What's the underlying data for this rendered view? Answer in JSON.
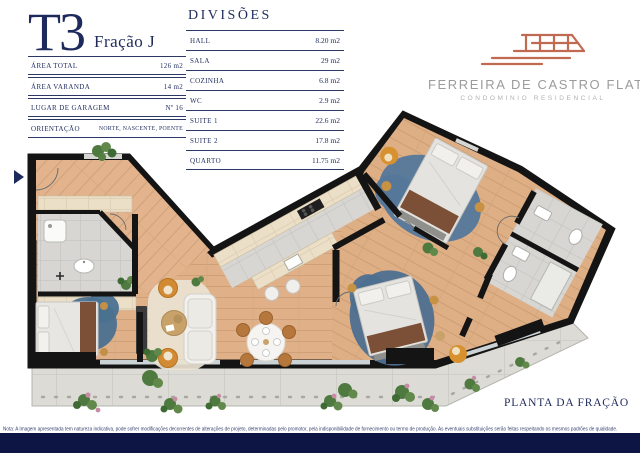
{
  "unit": {
    "type_label": "T3",
    "fraction_label": "Fração J",
    "details": [
      {
        "label": "ÁREA TOTAL",
        "value": "126 m2"
      },
      {
        "label": "ÁREA VARANDA",
        "value": "14 m2"
      },
      {
        "label": "LUGAR DE GARAGEM",
        "value": "Nº 16"
      },
      {
        "label": "ORIENTAÇÃO",
        "value": "NORTE, NASCENTE, POENTE"
      }
    ]
  },
  "divisions": {
    "title": "DIVISÕES",
    "rows": [
      {
        "label": "HALL",
        "value": "8.20 m2"
      },
      {
        "label": "SALA",
        "value": "29 m2"
      },
      {
        "label": "COZINHA",
        "value": "6.8 m2"
      },
      {
        "label": "WC",
        "value": "2.9 m2"
      },
      {
        "label": "SUITE 1",
        "value": "22.6 m2"
      },
      {
        "label": "SUITE 2",
        "value": "17.8 m2"
      },
      {
        "label": "QUARTO",
        "value": "11.75 m2"
      }
    ]
  },
  "brand": {
    "name": "FERREIRA DE CASTRO FLATS",
    "tagline": "CONDOMINIO  RESIDENCIAL",
    "logo_icon": "red-line-building-icon"
  },
  "plan": {
    "caption": "PLANTA DA FRAÇÃO",
    "entrance_marker": "navy-right-triangle"
  },
  "footer": {
    "note": "Nota: A Imagem apresentada tem natureza indicativa, pode sofrer modificações decorrentes de alterações de projeto, determinadas pelo promotor, pela indisponibilidade de fornecimento ou termo de produção. As eventuais substituições serão feitas respeitando os mesmos padrões de qualidade."
  },
  "colors": {
    "navy_text": "#1e2a5c",
    "footer_bar": "#0d1544",
    "brand_red": "#c06a52",
    "brand_gray": "#9b9b9b",
    "wall_black": "#141414",
    "wood_floor": "#e0b189",
    "tile_gray": "#d7d6d2",
    "closet_cream": "#ecdfc8",
    "rug_blue": "#4d7090",
    "accent_orange": "#d28a33",
    "plant_green": "#4e7a3f",
    "flower_pink": "#c78ba5",
    "balcony_concrete": "#dcdbd6"
  }
}
